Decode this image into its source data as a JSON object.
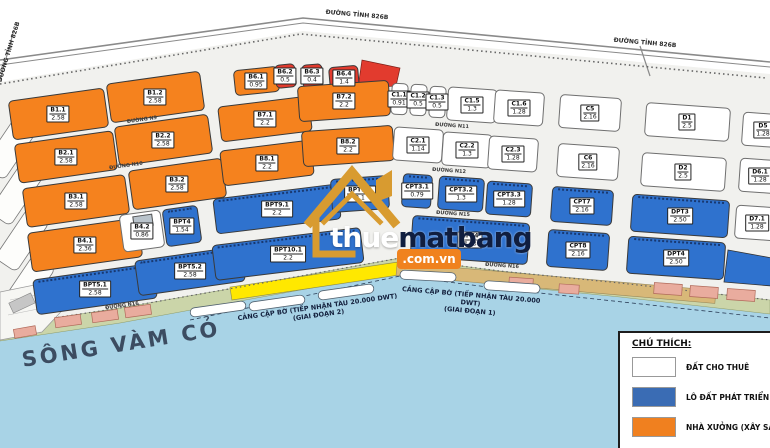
{
  "map": {
    "river_label": "SÔNG VÀM CỎ",
    "berths": [
      {
        "line1": "CẢNG CẬP BỜ (TIẾP NHẬN TÀU 20.000 DWT)",
        "line2": "(GIAI ĐOẠN 2)"
      },
      {
        "line1": "CẢNG CẬP BỜ (TIẾP NHẬN TÀU 20.000 DWT)",
        "line2": "(GIAI ĐOẠN 1)"
      }
    ],
    "road_labels": [
      "ĐƯỜNG TỈNH 826B",
      "ĐƯỜNG TỈNH 826B",
      "ĐƯỜNG TỈNH 826B",
      "ĐƯỜNG N9",
      "ĐƯỜNG N10",
      "ĐƯỜNG N11",
      "ĐƯỜNG N12",
      "ĐƯỜNG N15",
      "ĐƯỜNG N16",
      "ĐƯỜNG N16"
    ],
    "lots": [
      {
        "name": "B1.1",
        "area": "2.58",
        "type": "factory"
      },
      {
        "name": "B1.2",
        "area": "2.58",
        "type": "factory"
      },
      {
        "name": "B2.1",
        "area": "2.58",
        "type": "factory"
      },
      {
        "name": "B2.2",
        "area": "2.58",
        "type": "factory"
      },
      {
        "name": "B3.1",
        "area": "2.58",
        "type": "factory"
      },
      {
        "name": "B3.2",
        "area": "2.58",
        "type": "factory"
      },
      {
        "name": "B4.1",
        "area": "2.36",
        "type": "factory"
      },
      {
        "name": "B4.2",
        "area": "0.86",
        "type": "lease"
      },
      {
        "name": "B6.1",
        "area": "0.95",
        "type": "factory"
      },
      {
        "name": "B6.2",
        "area": "0.5",
        "type": "red"
      },
      {
        "name": "B6.3",
        "area": "0.4",
        "type": "red"
      },
      {
        "name": "B6.4",
        "area": "1.4",
        "type": "red"
      },
      {
        "name": "B7.1",
        "area": "2.2",
        "type": "factory"
      },
      {
        "name": "B7.2",
        "area": "2.2",
        "type": "factory"
      },
      {
        "name": "B8.1",
        "area": "2.2",
        "type": "factory"
      },
      {
        "name": "B8.2",
        "area": "2.2",
        "type": "factory"
      },
      {
        "name": "BPT4",
        "area": "1.54",
        "type": "develop"
      },
      {
        "name": "BPT5.1",
        "area": "2.58",
        "type": "develop"
      },
      {
        "name": "BPT5.2",
        "area": "2.58",
        "type": "develop"
      },
      {
        "name": "BPT9.1",
        "area": "2.2",
        "type": "develop"
      },
      {
        "name": "BPT9.2",
        "area": "2.1",
        "type": "develop"
      },
      {
        "name": "BPT10.1",
        "area": "2.2",
        "type": "develop"
      },
      {
        "name": "C1.1",
        "area": "0.91",
        "type": "lease"
      },
      {
        "name": "C1.2",
        "area": "0.5",
        "type": "lease"
      },
      {
        "name": "C1.3",
        "area": "0.5",
        "type": "lease"
      },
      {
        "name": "C1.5",
        "area": "1.3",
        "type": "lease"
      },
      {
        "name": "C1.6",
        "area": "1.28",
        "type": "lease"
      },
      {
        "name": "C2.1",
        "area": "1.14",
        "type": "lease"
      },
      {
        "name": "C2.2",
        "area": "1.3",
        "type": "lease"
      },
      {
        "name": "C2.3",
        "area": "1.28",
        "type": "lease"
      },
      {
        "name": "C5",
        "area": "2.16",
        "type": "lease"
      },
      {
        "name": "C6",
        "area": "2.16",
        "type": "lease"
      },
      {
        "name": "CPT3.1",
        "area": "0.79",
        "type": "develop"
      },
      {
        "name": "CPT3.2",
        "area": "1.3",
        "type": "develop"
      },
      {
        "name": "CPT3.3",
        "area": "1.28",
        "type": "develop"
      },
      {
        "name": "CPT4",
        "area": "3.63",
        "type": "develop"
      },
      {
        "name": "CPT7",
        "area": "2.16",
        "type": "develop"
      },
      {
        "name": "CPT8",
        "area": "2.16",
        "type": "develop"
      },
      {
        "name": "D1",
        "area": "2.5",
        "type": "lease"
      },
      {
        "name": "D2",
        "area": "2.5",
        "type": "lease"
      },
      {
        "name": "D5",
        "area": "1.28",
        "type": "lease"
      },
      {
        "name": "D6.1",
        "area": "1.28",
        "type": "lease"
      },
      {
        "name": "D7.1",
        "area": "1.28",
        "type": "lease"
      },
      {
        "name": "DPT3",
        "area": "2.50",
        "type": "develop"
      },
      {
        "name": "DPT4",
        "area": "2.50",
        "type": "develop"
      }
    ]
  },
  "legend": {
    "title": "CHÚ THÍCH:",
    "items": [
      {
        "label": "ĐẤT CHO THUÊ",
        "color": "#FFFFFF"
      },
      {
        "label": "LÔ ĐẤT PHÁT TRIỂN",
        "color": "#3A6CB4"
      },
      {
        "label": "NHÀ XƯỞNG (XÂY SẴN)",
        "color": "#F0801F"
      }
    ]
  },
  "watermark": {
    "part1": "thue",
    "part2": "matbang",
    "badge": ".com.vn"
  },
  "colors": {
    "lot": {
      "factory": "#F5821E",
      "develop": "#2F72CE",
      "lease": "#FFFFFF",
      "red": "#E23B2E"
    },
    "water": "#A8D3E6",
    "shore": "#CBD5A9",
    "berth_yellow": "#FFE800",
    "berth_tan": "#D8B878",
    "watermark_orange": "#F0821E",
    "watermark_gold": "#D89B30"
  }
}
